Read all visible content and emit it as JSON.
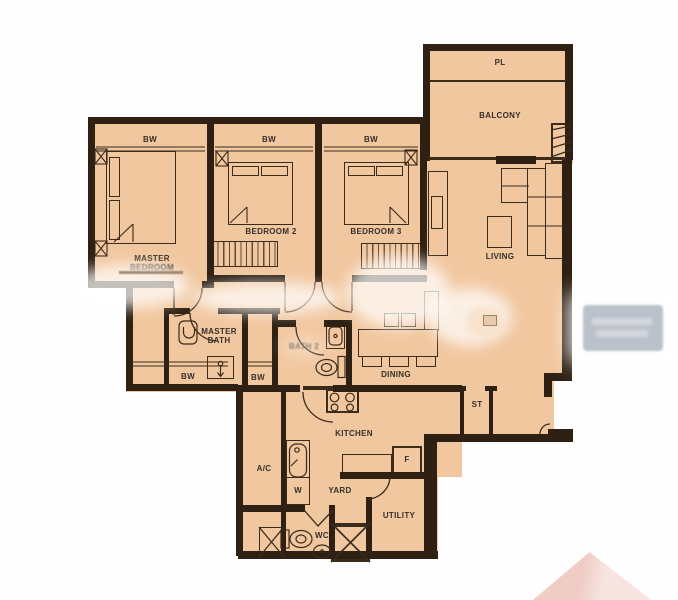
{
  "floorplan": {
    "labels": {
      "pl": "PL",
      "balcony": "BALCONY",
      "living": "LIVING",
      "dining": "DINING",
      "kitchen": "KITCHEN",
      "yard": "YARD",
      "utility": "UTILITY",
      "wc": "WC",
      "ac": "A/C",
      "store": "ST",
      "fridge": "F",
      "washer": "W",
      "bay_window": "BW",
      "master_bedroom": [
        "MASTER",
        "BEDROOM"
      ],
      "bedroom2": "BEDROOM 2",
      "bedroom3": "BEDROOM 3",
      "master_bath": [
        "MASTER",
        "BATH"
      ],
      "bath2": "BATH 2"
    },
    "colors": {
      "floor": "#f1c79f",
      "wall": "#2e2113",
      "line": "#3b2b1b",
      "text": "#35302a",
      "background": "#fefefe",
      "watermark_gray": "#b6bdc6",
      "watermark_pink": "#eecac2"
    }
  }
}
